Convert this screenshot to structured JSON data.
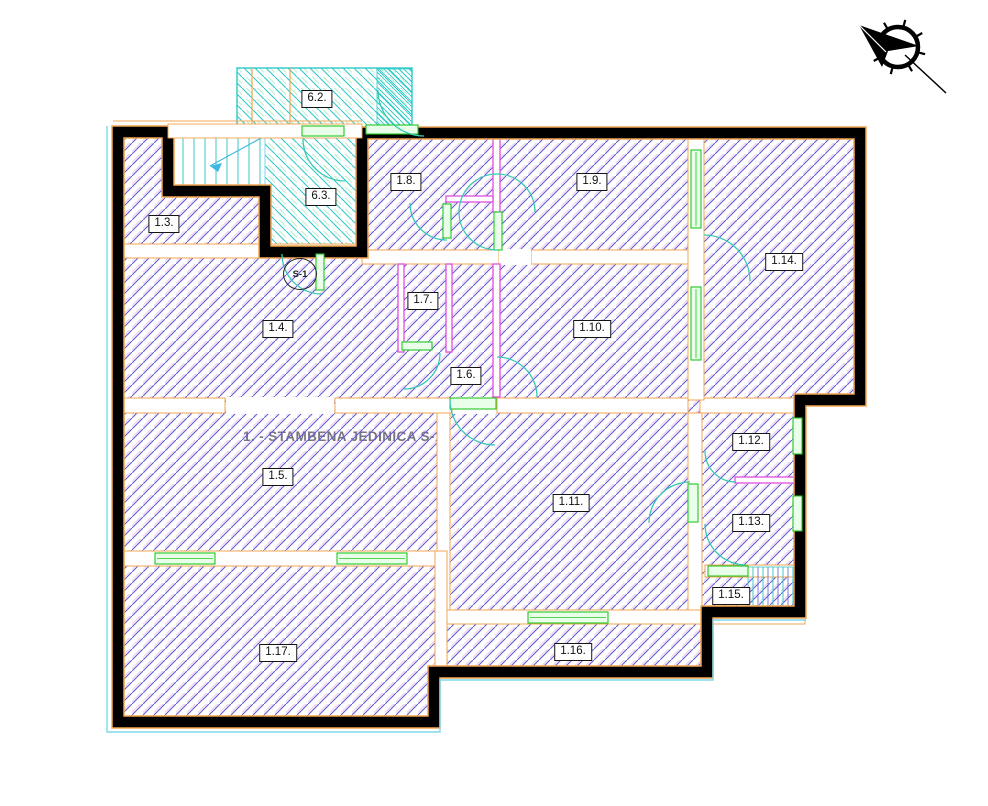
{
  "plan": {
    "unit_annotation": "1. - STAMBENA JEDINICA S-1",
    "s1_badge": "S-1",
    "rooms": [
      {
        "id": "6.2",
        "label": "6.2.",
        "x": 317,
        "y": 99
      },
      {
        "id": "6.3",
        "label": "6.3.",
        "x": 321,
        "y": 197
      },
      {
        "id": "1.3",
        "label": "1.3.",
        "x": 164,
        "y": 224
      },
      {
        "id": "1.8",
        "label": "1.8.",
        "x": 406,
        "y": 182
      },
      {
        "id": "1.9",
        "label": "1.9.",
        "x": 592,
        "y": 182
      },
      {
        "id": "1.14",
        "label": "1.14.",
        "x": 784,
        "y": 262
      },
      {
        "id": "1.7",
        "label": "1.7.",
        "x": 423,
        "y": 301
      },
      {
        "id": "1.4",
        "label": "1.4.",
        "x": 278,
        "y": 329
      },
      {
        "id": "1.10",
        "label": "1.10.",
        "x": 592,
        "y": 329
      },
      {
        "id": "1.6",
        "label": "1.6.",
        "x": 466,
        "y": 376
      },
      {
        "id": "1.12",
        "label": "1.12.",
        "x": 751,
        "y": 442
      },
      {
        "id": "1.5",
        "label": "1.5.",
        "x": 278,
        "y": 477
      },
      {
        "id": "1.11",
        "label": "1.11.",
        "x": 571,
        "y": 503
      },
      {
        "id": "1.13",
        "label": "1.13.",
        "x": 751,
        "y": 523
      },
      {
        "id": "1.15",
        "label": "1.15.",
        "x": 731,
        "y": 596
      },
      {
        "id": "1.17",
        "label": "1.17.",
        "x": 278,
        "y": 653
      },
      {
        "id": "1.16",
        "label": "1.16.",
        "x": 573,
        "y": 652
      }
    ],
    "icons": {
      "north_arrow": "north-arrow"
    },
    "colors": {
      "unit_hatch": "#5b5bd6",
      "unit_hatch_fringe": "#e070c8",
      "common_hatch": "#2fc9c9",
      "wall_line": "#f2a652",
      "partition": "#e04ee0",
      "window_green": "#21c521",
      "door_arc": "#35c9b4",
      "boundary": "#000000",
      "exterior_line": "#7fd8e8"
    }
  }
}
